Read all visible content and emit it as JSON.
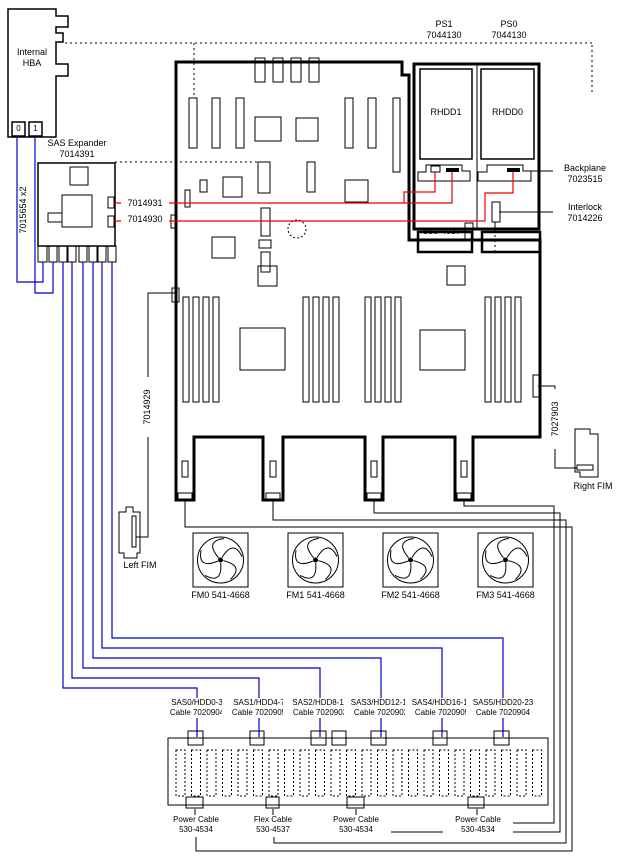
{
  "hba": {
    "label": "Internal\nHBA",
    "ports": [
      "0",
      "1"
    ]
  },
  "expander": {
    "label": "SAS Expander\n7014391"
  },
  "cables": {
    "hba_to_expander": "7015654 x2",
    "expander_top": "7014931",
    "expander_bottom": "7014930",
    "motherboard_left": "7014929",
    "motherboard_right": "7027903",
    "connector_530_4037": "530-4037"
  },
  "power_supplies": {
    "ps1": "PS1\n7044130",
    "ps0": "PS0\n7044130"
  },
  "drives": {
    "rhdd1": "RHDD1",
    "rhdd0": "RHDD0"
  },
  "backplane": {
    "label": "Backplane\n7023515"
  },
  "interlock": {
    "label": "Interlock\n7014226"
  },
  "fims": {
    "left": "Left FIM",
    "right": "Right FIM"
  },
  "fans": [
    {
      "label": "FM0 541-4668"
    },
    {
      "label": "FM1 541-4668"
    },
    {
      "label": "FM2 541-4668"
    },
    {
      "label": "FM3 541-4668"
    }
  ],
  "sas_cables": [
    {
      "id": "SAS0/HDD0-3",
      "cable": "Cable 7020904"
    },
    {
      "id": "SAS1/HDD4-7",
      "cable": "Cable 7020905"
    },
    {
      "id": "SAS2/HDD8-11",
      "cable": "Cable 7020903"
    },
    {
      "id": "SAS3/HDD12-15",
      "cable": "Cable 7020903"
    },
    {
      "id": "SAS4/HDD16-19",
      "cable": "Cable 7020905"
    },
    {
      "id": "SAS5/HDD20-23",
      "cable": "Cable 7020904"
    }
  ],
  "bottom_cables": [
    {
      "name": "Power Cable",
      "part": "530-4534"
    },
    {
      "name": "Flex Cable",
      "part": "530-4537"
    },
    {
      "name": "Power Cable",
      "part": "530-4534"
    },
    {
      "name": "Power Cable",
      "part": "530-4534"
    }
  ],
  "colors": {
    "cable_blue": "#0000CC",
    "cable_red": "#EE0000",
    "line": "#000000"
  }
}
